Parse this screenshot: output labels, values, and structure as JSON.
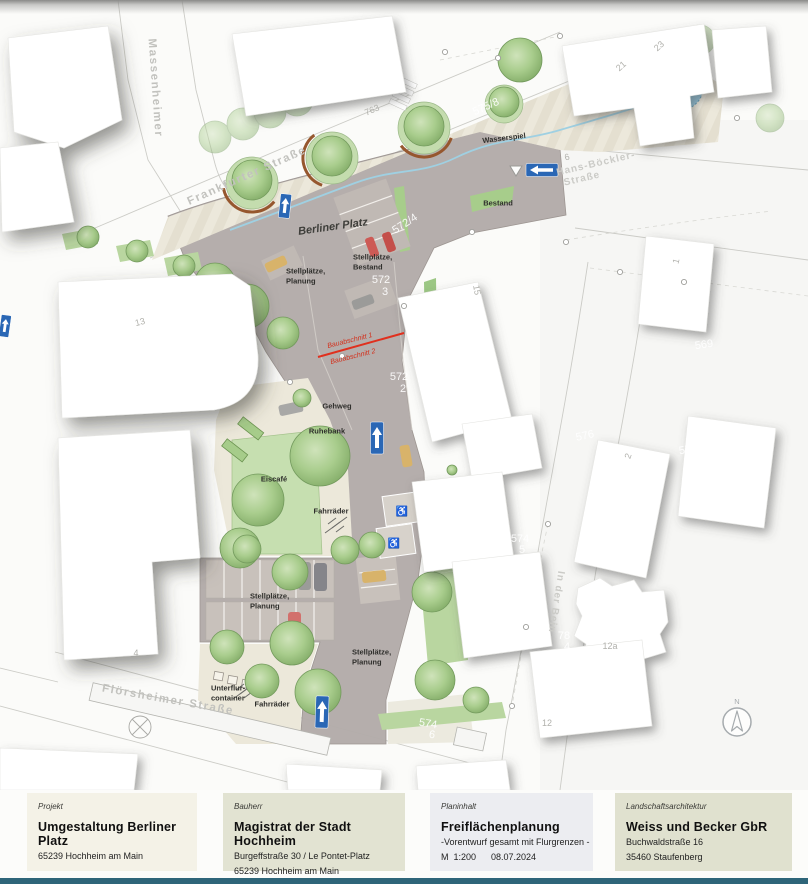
{
  "map": {
    "north_label": "N",
    "red_line": {
      "x1": 318,
      "y1": 357,
      "x2": 404,
      "y2": 333
    },
    "labels": [
      {
        "t": "Massenheimer",
        "x": 155,
        "y": 88,
        "r": 86,
        "k": "street",
        "n": "street-label-massenheimer"
      },
      {
        "t": "Frankfurter Straße",
        "x": 247,
        "y": 176,
        "r": -24,
        "k": "street",
        "n": "street-label-frankfurter-strasse"
      },
      {
        "t": "Flörsheimer Straße",
        "x": 168,
        "y": 700,
        "r": 10,
        "k": "street",
        "n": "street-label-floersheimer-strasse"
      },
      {
        "t": "Hans-Böckler-",
        "x": 596,
        "y": 164,
        "r": -13,
        "k": "street2",
        "n": "street-label-hans-boeckler-strasse"
      },
      {
        "t": "Straße",
        "x": 582,
        "y": 179,
        "r": -13,
        "k": "street2",
        "n": "street-label-hans-boeckler-strasse-2"
      },
      {
        "t": "In der Bein",
        "x": 556,
        "y": 602,
        "r": 99,
        "k": "street2",
        "n": "street-label-in-der-bein"
      },
      {
        "t": "Berliner Platz",
        "x": 333,
        "y": 227,
        "r": -8,
        "k": "plaza",
        "n": "plaza-label"
      },
      {
        "t": "Wasserspiel",
        "x": 504,
        "y": 138,
        "r": -7,
        "k": "feature",
        "n": "label-wasserspiel"
      },
      {
        "t": "Bestand",
        "x": 498,
        "y": 203,
        "k": "feature",
        "n": "label-bestand"
      },
      {
        "t": "Stellplätze,",
        "x": 353,
        "y": 257,
        "a": "left",
        "k": "feature",
        "n": "label-stellplaetze-bestand"
      },
      {
        "t": "Bestand",
        "x": 353,
        "y": 267,
        "a": "left",
        "k": "feature",
        "n": "label-stellplaetze-bestand-2"
      },
      {
        "t": "Stellplätze,",
        "x": 286,
        "y": 271,
        "a": "left",
        "k": "feature",
        "n": "label-stellplaetze-planung-nw"
      },
      {
        "t": "Planung",
        "x": 286,
        "y": 281,
        "a": "left",
        "k": "feature",
        "n": "label-stellplaetze-planung-nw-2"
      },
      {
        "t": "Gehweg",
        "x": 337,
        "y": 406,
        "k": "feature",
        "n": "label-gehweg"
      },
      {
        "t": "Ruhebank",
        "x": 327,
        "y": 431,
        "k": "feature",
        "n": "label-ruhebank"
      },
      {
        "t": "Eiscafé",
        "x": 274,
        "y": 479,
        "k": "feature",
        "n": "label-eiscafe"
      },
      {
        "t": "Fahrräder",
        "x": 331,
        "y": 511,
        "k": "feature",
        "n": "label-fahrraeder-mitte"
      },
      {
        "t": "Stellplätze,",
        "x": 250,
        "y": 596,
        "a": "left",
        "k": "feature",
        "n": "label-stellplaetze-planung-sw"
      },
      {
        "t": "Planung",
        "x": 250,
        "y": 606,
        "a": "left",
        "k": "feature",
        "n": "label-stellplaetze-planung-sw-2"
      },
      {
        "t": "Stellplätze,",
        "x": 352,
        "y": 652,
        "a": "left",
        "k": "feature",
        "n": "label-stellplaetze-planung-se"
      },
      {
        "t": "Planung",
        "x": 352,
        "y": 662,
        "a": "left",
        "k": "feature",
        "n": "label-stellplaetze-planung-se-2"
      },
      {
        "t": "Unterflur-",
        "x": 211,
        "y": 688,
        "a": "left",
        "k": "feature",
        "n": "label-unterflurcontainer"
      },
      {
        "t": "container",
        "x": 211,
        "y": 698,
        "a": "left",
        "k": "feature",
        "n": "label-unterflurcontainer-2"
      },
      {
        "t": "Fahrräder",
        "x": 272,
        "y": 704,
        "k": "feature",
        "n": "label-fahrraeder-sued"
      },
      {
        "t": "Bauabschnitt 1",
        "x": 350,
        "y": 341,
        "r": -14,
        "k": "red",
        "n": "label-bauabschnitt-1"
      },
      {
        "t": "Bauabschnitt 2",
        "x": 353,
        "y": 357,
        "r": -14,
        "k": "red",
        "n": "label-bauabschnitt-2"
      },
      {
        "t": "572/4",
        "x": 405,
        "y": 224,
        "r": -33,
        "k": "parcel-white",
        "n": "parcel-572-4"
      },
      {
        "t": "572",
        "x": 381,
        "y": 280,
        "k": "parcel-white",
        "n": "parcel-572-3"
      },
      {
        "t": "3",
        "x": 385,
        "y": 292,
        "k": "parcel-white",
        "n": "parcel-572-3b"
      },
      {
        "t": "572",
        "x": 399,
        "y": 377,
        "k": "parcel-white",
        "n": "parcel-572-2"
      },
      {
        "t": "2",
        "x": 403,
        "y": 389,
        "k": "parcel-white",
        "n": "parcel-572-2b"
      },
      {
        "t": "569",
        "x": 704,
        "y": 345,
        "r": -8,
        "k": "parcel-white",
        "n": "parcel-569"
      },
      {
        "t": "576",
        "x": 585,
        "y": 436,
        "r": -12,
        "k": "parcel-white",
        "n": "parcel-576"
      },
      {
        "t": "570",
        "x": 688,
        "y": 450,
        "r": -8,
        "k": "parcel-white",
        "n": "parcel-570-1"
      },
      {
        "t": "1",
        "x": 690,
        "y": 461,
        "r": -8,
        "k": "parcel-white",
        "n": "parcel-570-1b"
      },
      {
        "t": "575/8",
        "x": 486,
        "y": 107,
        "r": -24,
        "k": "parcel-white",
        "n": "parcel-575-8"
      },
      {
        "t": "574",
        "x": 520,
        "y": 539,
        "k": "parcel-white",
        "n": "parcel-574-5"
      },
      {
        "t": "5",
        "x": 522,
        "y": 550,
        "k": "parcel-white",
        "n": "parcel-574-5b"
      },
      {
        "t": "78",
        "x": 564,
        "y": 636,
        "k": "parcel-white",
        "n": "parcel-78-4"
      },
      {
        "t": "4",
        "x": 567,
        "y": 647,
        "k": "parcel-white",
        "n": "parcel-78-4b"
      },
      {
        "t": "574",
        "x": 428,
        "y": 724,
        "r": 9,
        "k": "parcel-white",
        "n": "parcel-574-6"
      },
      {
        "t": "6",
        "x": 432,
        "y": 735,
        "r": 9,
        "k": "parcel-white",
        "n": "parcel-574-6b"
      },
      {
        "t": "763",
        "x": 372,
        "y": 110,
        "r": -24,
        "k": "parcel-gray",
        "n": "parcel-763"
      },
      {
        "t": "13",
        "x": 140,
        "y": 322,
        "r": -14,
        "k": "parcel-gray",
        "n": "house-13"
      },
      {
        "t": "21",
        "x": 621,
        "y": 66,
        "r": -42,
        "k": "parcel-gray",
        "n": "house-21"
      },
      {
        "t": "23",
        "x": 659,
        "y": 46,
        "r": -42,
        "k": "parcel-gray",
        "n": "house-23"
      },
      {
        "t": "15",
        "x": 477,
        "y": 290,
        "r": 80,
        "k": "parcel-gray",
        "n": "house-15"
      },
      {
        "t": "1",
        "x": 676,
        "y": 261,
        "r": -75,
        "k": "parcel-gray",
        "n": "house-1"
      },
      {
        "t": "2",
        "x": 628,
        "y": 456,
        "r": -70,
        "k": "parcel-gray",
        "n": "house-2"
      },
      {
        "t": "12a",
        "x": 610,
        "y": 646,
        "k": "parcel-gray",
        "n": "house-12a"
      },
      {
        "t": "12",
        "x": 547,
        "y": 723,
        "k": "parcel-gray",
        "n": "house-12"
      },
      {
        "t": "4",
        "x": 136,
        "y": 653,
        "k": "parcel-gray",
        "n": "house-4"
      },
      {
        "t": "6",
        "x": 567,
        "y": 157,
        "r": -13,
        "k": "parcel-gray",
        "n": "parcel-6"
      },
      {
        "t": "♿",
        "x": 402,
        "y": 512,
        "k": "glyph",
        "n": "wheelchair-icon"
      },
      {
        "t": "♿",
        "x": 394,
        "y": 544,
        "k": "glyph",
        "n": "wheelchair-icon"
      }
    ]
  },
  "titleblock": {
    "panels": [
      {
        "kicker": "Projekt",
        "title": "Umgestaltung Berliner Platz",
        "lines": [
          "65239 Hochheim am Main"
        ]
      },
      {
        "kicker": "Bauherr",
        "title": "Magistrat der Stadt Hochheim",
        "lines": [
          "Burgeffstraße 30 / Le Pontet-Platz",
          "65239 Hochheim am Main"
        ]
      },
      {
        "kicker": "Planinhalt",
        "title": "Freiflächenplanung",
        "lines": [
          "-Vorentwurf gesamt mit Flurgrenzen -",
          "M  1:200      08.07.2024"
        ]
      },
      {
        "kicker": "Landschaftsarchitektur",
        "title": "Weiss und Becker GbR",
        "lines": [
          "Buchwaldstraße 16",
          "35460 Staufenberg"
        ]
      }
    ]
  }
}
